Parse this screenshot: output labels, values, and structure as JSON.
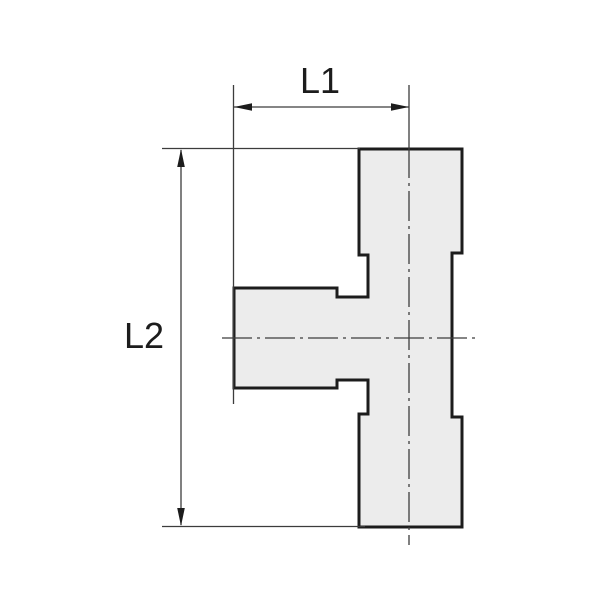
{
  "drawing": {
    "type": "technical-drawing-t-fitting",
    "labels": {
      "l1": "L1",
      "l2": "L2"
    },
    "colors": {
      "outline": "#1c1c1c",
      "part_fill": "#ececec",
      "thin_line": "#3c3c3c",
      "text": "#1c1c1c",
      "background": "#ffffff"
    }
  }
}
